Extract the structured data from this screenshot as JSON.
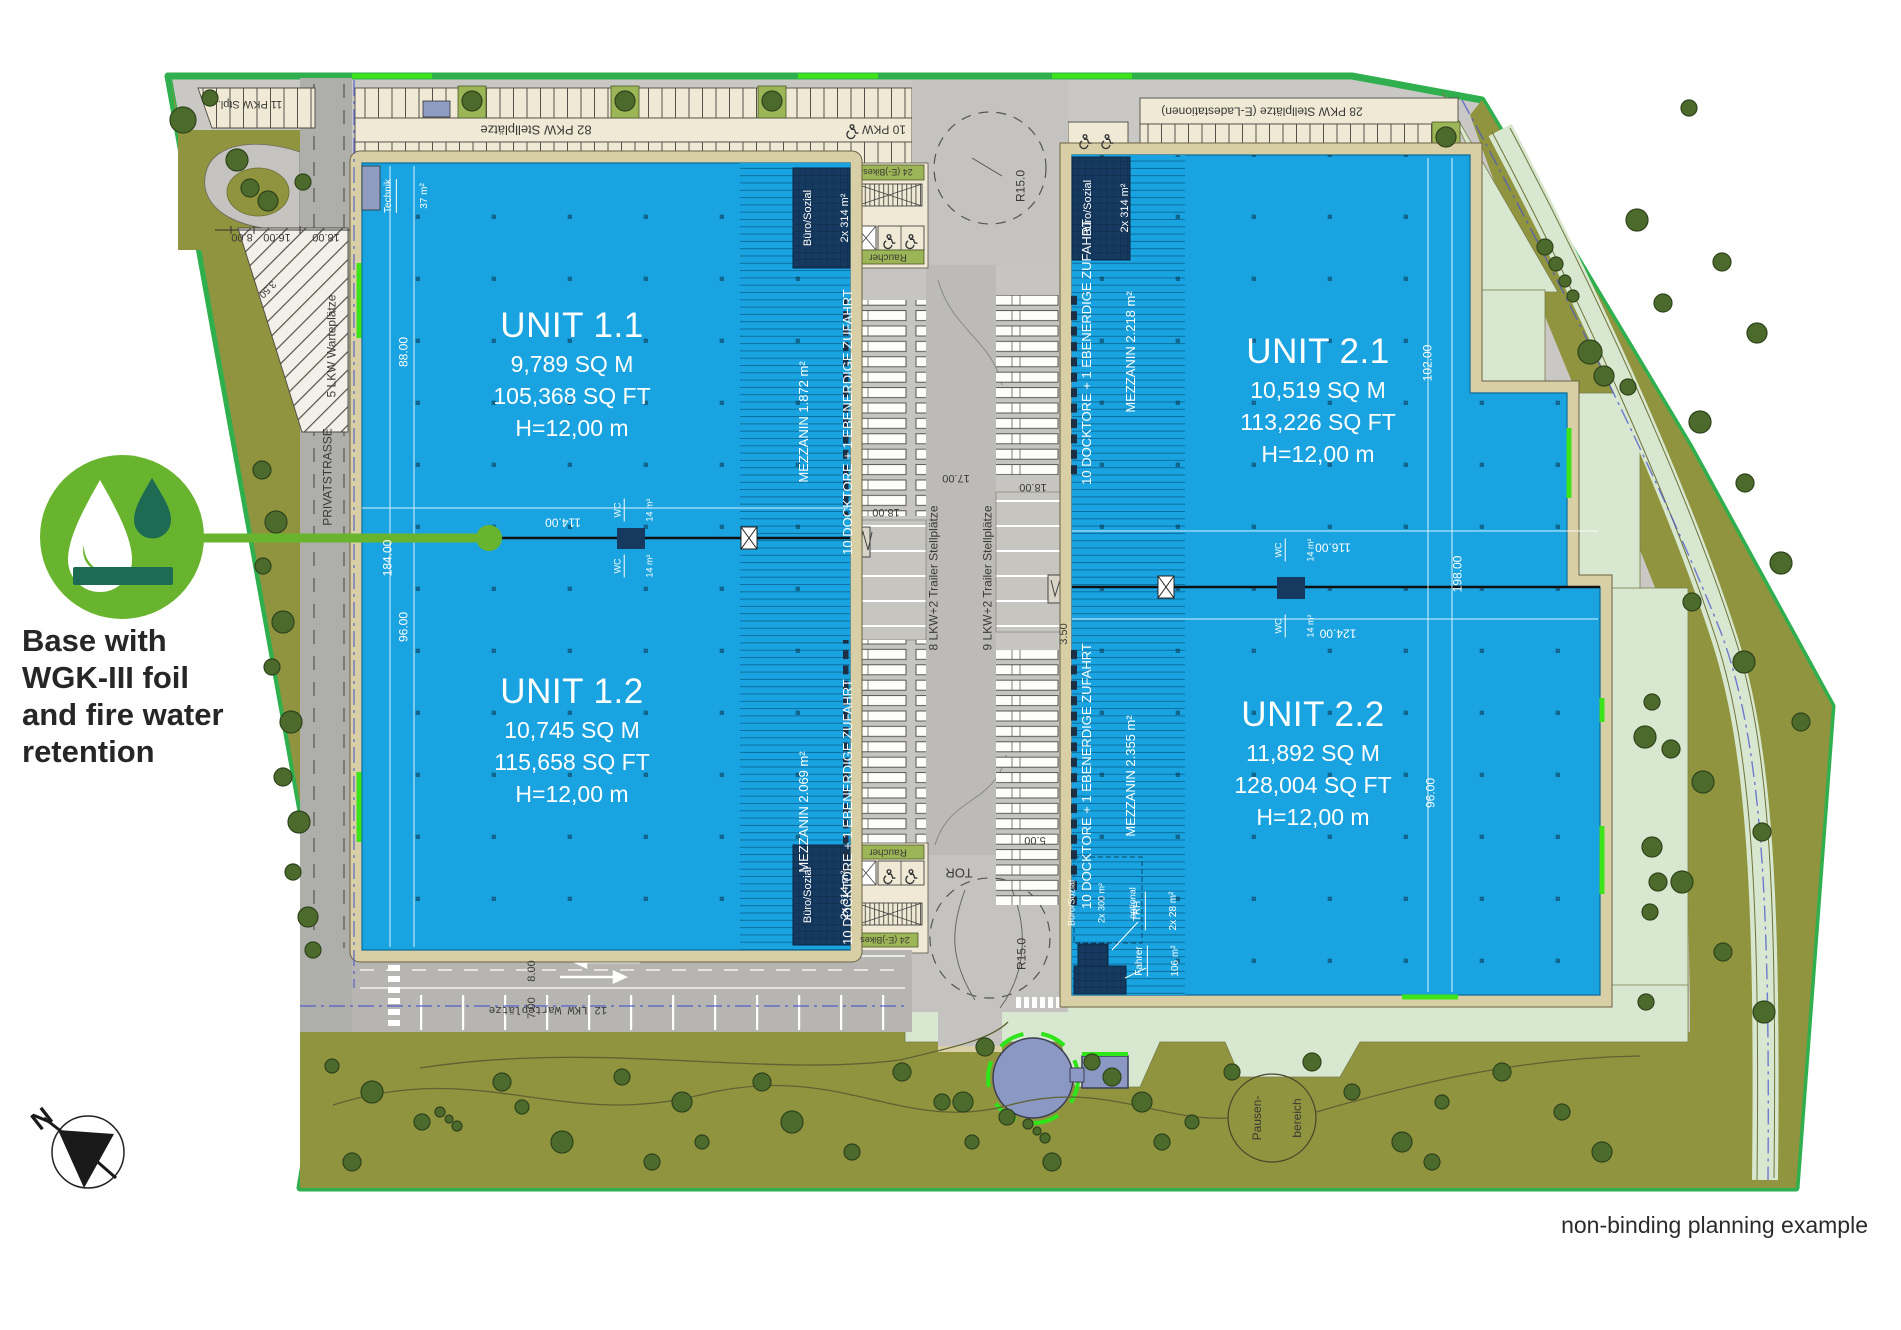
{
  "plan": {
    "units": [
      {
        "name": "UNIT 1.1",
        "sqm": "9,789 SQ M",
        "sqft": "105,368 SQ FT",
        "height": "H=12,00 m",
        "mezzanin": "MEZZANIN 1.872 m²",
        "docks": "10 DOCKTORE + 1 EBENERDIGE ZUFAHRT",
        "buero": "Büro/Sozial",
        "buero_area": "2x 314 m²"
      },
      {
        "name": "UNIT 1.2",
        "sqm": "10,745 SQ M",
        "sqft": "115,658 SQ FT",
        "height": "H=12,00 m",
        "mezzanin": "MEZZANIN 2.069 m²",
        "docks": "10 DOCKTORE + 1 EBENERDIGE ZUFAHRT",
        "buero": "Büro/Sozial",
        "buero_area": "2x 314 m²"
      },
      {
        "name": "UNIT 2.1",
        "sqm": "10,519 SQ M",
        "sqft": "113,226 SQ FT",
        "height": "H=12,00 m",
        "mezzanin": "MEZZANIN 2.218 m²",
        "docks": "10 DOCKTORE + 1 EBENERDIGE ZUFAHRT",
        "buero": "Büro/Sozial",
        "buero_area": "2x 314 m²"
      },
      {
        "name": "UNIT 2.2",
        "sqm": "11,892 SQ M",
        "sqft": "128,004 SQ FT",
        "height": "H=12,00 m",
        "mezzanin": "MEZZANIN 2.355 m²",
        "docks": "10 DOCKTORE + 1 EBENERDIGE ZUFAHRT",
        "buero": "Büro/Sozial",
        "buero_area": "2x 300 m²",
        "buero_note": "optional",
        "trh": "TRH",
        "trh_area": "2x 28 m²",
        "fahrer": "Fahrer",
        "fahrer_area": "106 m²"
      }
    ],
    "labels": {
      "privatstrasse": "PRIVATSTRASSE",
      "lkw5": "5 LKW Warteplätze",
      "lkw12": "12 LKW Warteplätze",
      "pkw11": "11 PKW Stpl.",
      "pkw82": "82 PKW Stellplätze",
      "pkw10": "10 PKW",
      "pkw28": "28 PKW Stellplätze (E-Ladestationen)",
      "trailer8": "8 LKW+2 Trailer Stellplätze",
      "trailer9": "9 LKW+2 Trailer Stellplätze",
      "technik": "Technik",
      "technik_area": "37 m²",
      "wc": "WC",
      "wc_area": "14 m²",
      "raucher": "Raucher",
      "ebikes": "24 (E-)Bikes",
      "tor": "TOR",
      "pause_line1": "Pausen-",
      "pause_line2": "bereich"
    },
    "dims": {
      "d5": "5.00",
      "d7": "7.00",
      "d8": "8.00",
      "d16": "16.00",
      "d17": "17.00",
      "d18": "18.00",
      "d88": "88.00",
      "d96": "96.00",
      "d102": "102.00",
      "d114": "114.00",
      "d116": "116.00",
      "d124": "124.00",
      "d184": "184.00",
      "d198": "198.00",
      "d350": "3.50",
      "r15": "R15.0"
    },
    "callout": {
      "line1": "Base with",
      "line2": "WGK-III foil",
      "line3": "and fire water",
      "line4": "retention"
    },
    "compass": {
      "north": "N"
    },
    "footer": {
      "note": "non-binding planning example"
    },
    "colors": {
      "building_blue": "#19A3E0",
      "site_border_green": "#2FAF4D",
      "accent_green": "#3FE31A",
      "navy": "#16395F",
      "olive": "#90943E",
      "pale_green": "#D8E7D0",
      "callout_green": "#69B42E",
      "callout_dark_green": "#1C6B52",
      "pond_blue": "#8B98C3"
    }
  }
}
